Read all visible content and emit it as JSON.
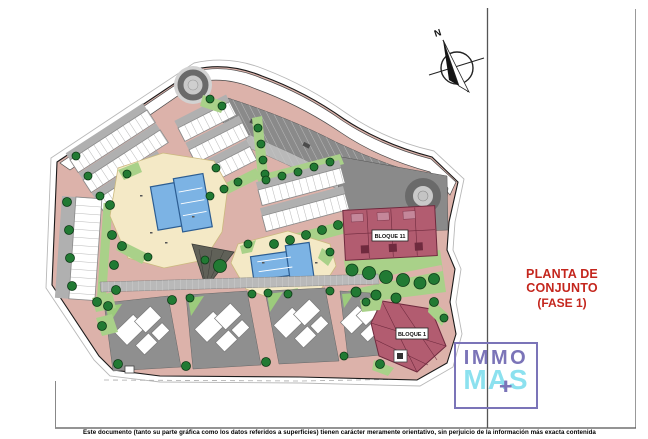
{
  "sheet": {
    "background": "#ffffff"
  },
  "north_arrow": {
    "label": "N"
  },
  "plan": {
    "block_11_label": "BLOQUE 11",
    "block_1_label": "BLOQUE 1"
  },
  "title_block": {
    "title": "PLANTA DE CONJUNTO",
    "subtitle": "(FASE 1)"
  },
  "logo": {
    "word_top": "IMMO",
    "word_bottom": "MAS",
    "plus_sign": "+"
  },
  "footer": {
    "disclaimer": "Este documento (tanto su parte gráfica como los datos referidos a superficies) tienen carácter meramente orientativo, sin perjuicio de la información más exacta contenida"
  },
  "colors": {
    "title-red": "#c4261d",
    "logo-purple": "#7b74b8",
    "logo-cyan": "#8ce1ef",
    "road": "#dcb2aa",
    "cream": "#f4e9c6",
    "pool": "#7cb3e4",
    "pool-edge": "#2c5d92",
    "block": "#b25c70",
    "block-dark": "#6f2a3e",
    "block-light": "#c4879a",
    "green": "#a9d189",
    "green-tri": "#9ccb7c",
    "tree": "#217a33",
    "tree-dark": "#0d3a16",
    "gray-dark": "#8a8a8a",
    "gray-mid": "#b9b9b9",
    "gray-light": "#c9c9c9",
    "plot-gray": "#8f8f8f",
    "carport": "#b0b0b0"
  }
}
